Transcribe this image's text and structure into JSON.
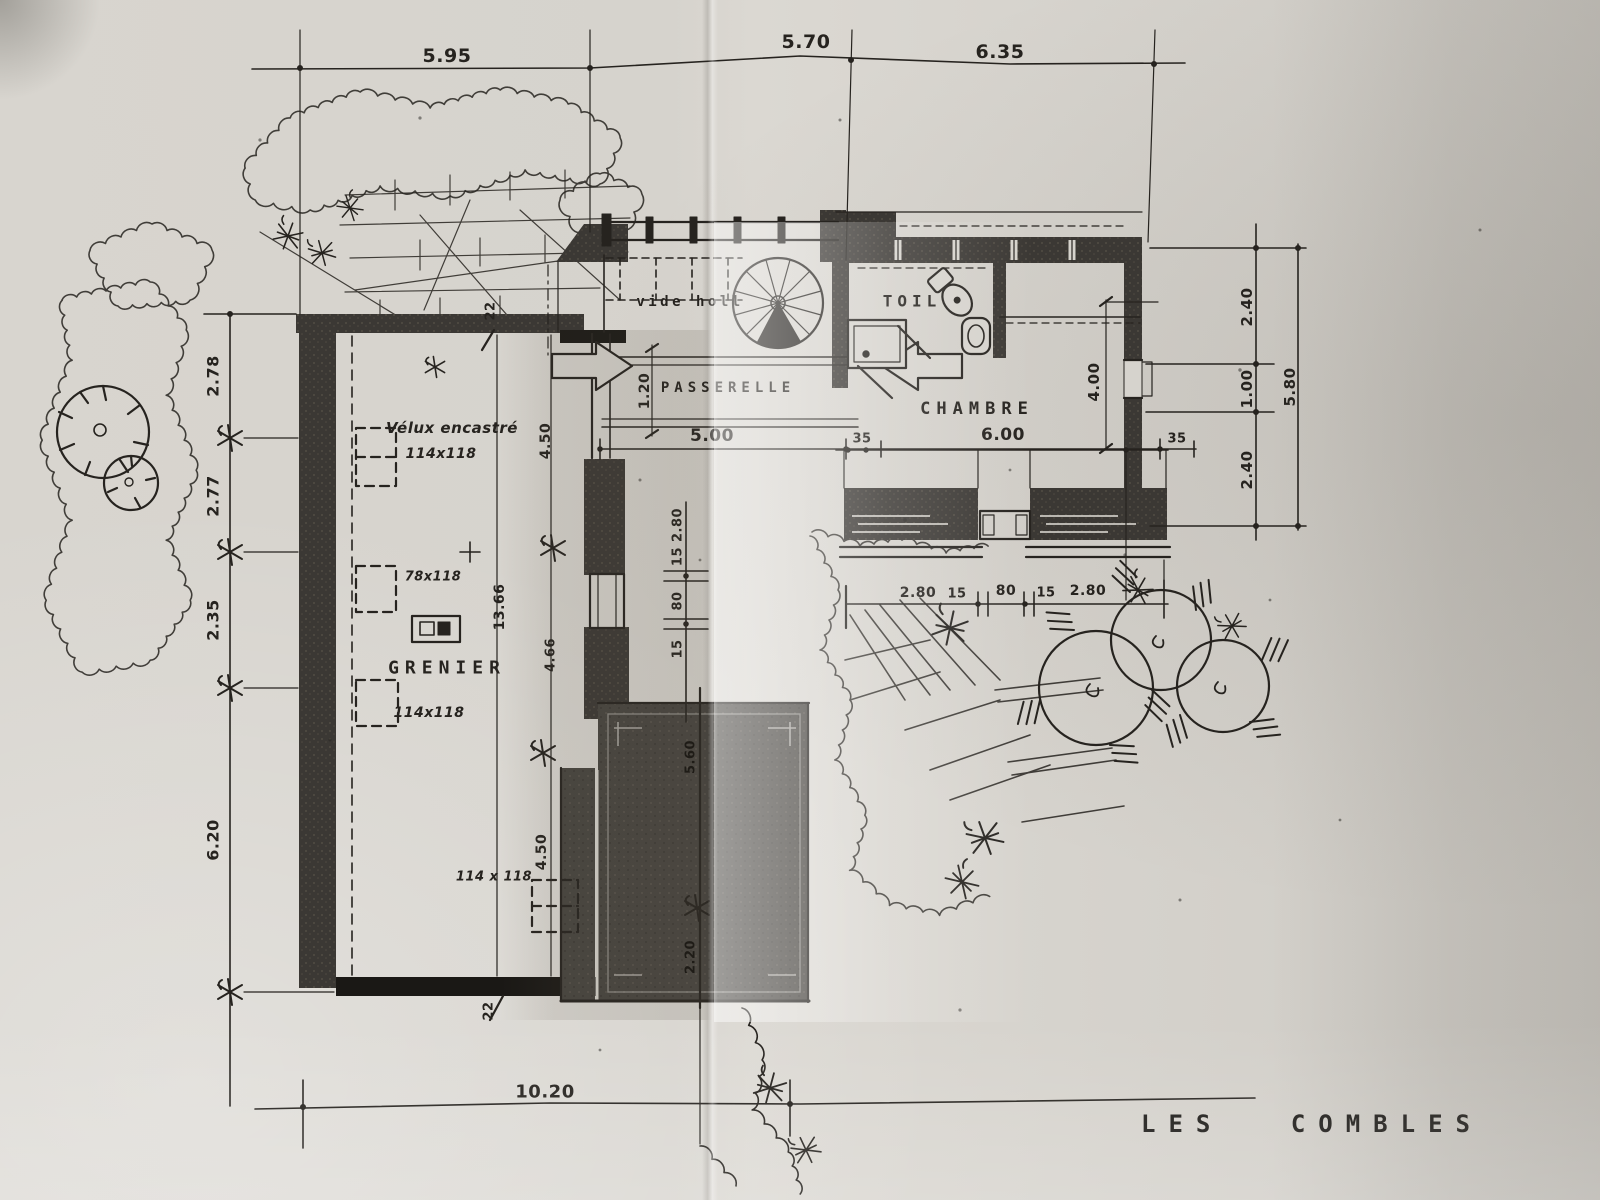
{
  "title": "LES COMBLES",
  "rooms": {
    "vide": "vide holl",
    "toil": "TOIL",
    "chambre": "CHAMBRE",
    "passerelle": "PASSERELLE",
    "grenier": "GRENIER"
  },
  "notes": {
    "velux": "Vélux encastré",
    "size1": "114x118",
    "size2": "78x118",
    "size3": "114x118",
    "size4": "114 x 118"
  },
  "dims": {
    "top": [
      "5.95",
      "5.70",
      "6.35"
    ],
    "left": [
      "2.78",
      "2.77",
      "2.35",
      "6.20"
    ],
    "right": [
      "2.40",
      "1.00",
      "2.40"
    ],
    "right_total": "5.80",
    "mid": [
      "5.00",
      "35",
      "6.00",
      "35"
    ],
    "depth": "4.00",
    "bridge": "1.20",
    "south": [
      "2.80",
      "15",
      "80",
      "15",
      "2.80"
    ],
    "gap": [
      "15 2.80",
      "80",
      "15"
    ],
    "grenier": [
      "4.50",
      "13.66",
      "4.66",
      "4.50"
    ],
    "wall": [
      "22",
      "22"
    ],
    "terrace": [
      "5.60",
      "2.20"
    ],
    "bottom": "10.20"
  },
  "colors": {
    "ink": "#26231f",
    "paper": "#d6d3cd",
    "wall": "#3b3834"
  }
}
